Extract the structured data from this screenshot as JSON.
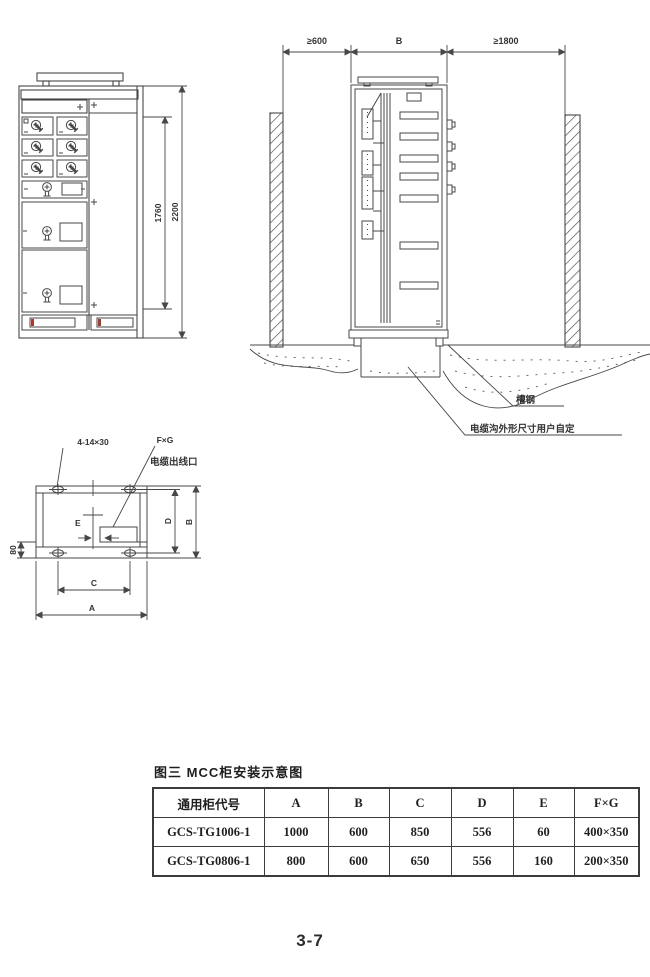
{
  "page": {
    "number": "3-7"
  },
  "front_view": {
    "inner_height": "1760",
    "total_height": "2200"
  },
  "side_view": {
    "rear_clearance": "≥600",
    "depth_label": "B",
    "front_clearance": "≥1800",
    "channel_steel_label": "槽钢",
    "trench_note": "电缆沟外形尺寸用户自定"
  },
  "plan_view": {
    "holes_label": "4-14×30",
    "fxg_label": "F×G",
    "cable_outlet_label": "电缆出线口",
    "e_label": "E",
    "offset_label": "80",
    "c_label": "C",
    "a_label": "A",
    "d_label": "D",
    "b_label": "B"
  },
  "table": {
    "title": "图三  MCC柜安装示意图",
    "headers": [
      "通用柜代号",
      "A",
      "B",
      "C",
      "D",
      "E",
      "F×G"
    ],
    "rows": [
      [
        "GCS-TG1006-1",
        "1000",
        "600",
        "850",
        "556",
        "60",
        "400×350"
      ],
      [
        "GCS-TG0806-1",
        "800",
        "600",
        "650",
        "556",
        "160",
        "200×350"
      ]
    ]
  },
  "colors": {
    "line": "#474747",
    "accent_red": "#a8392e"
  }
}
